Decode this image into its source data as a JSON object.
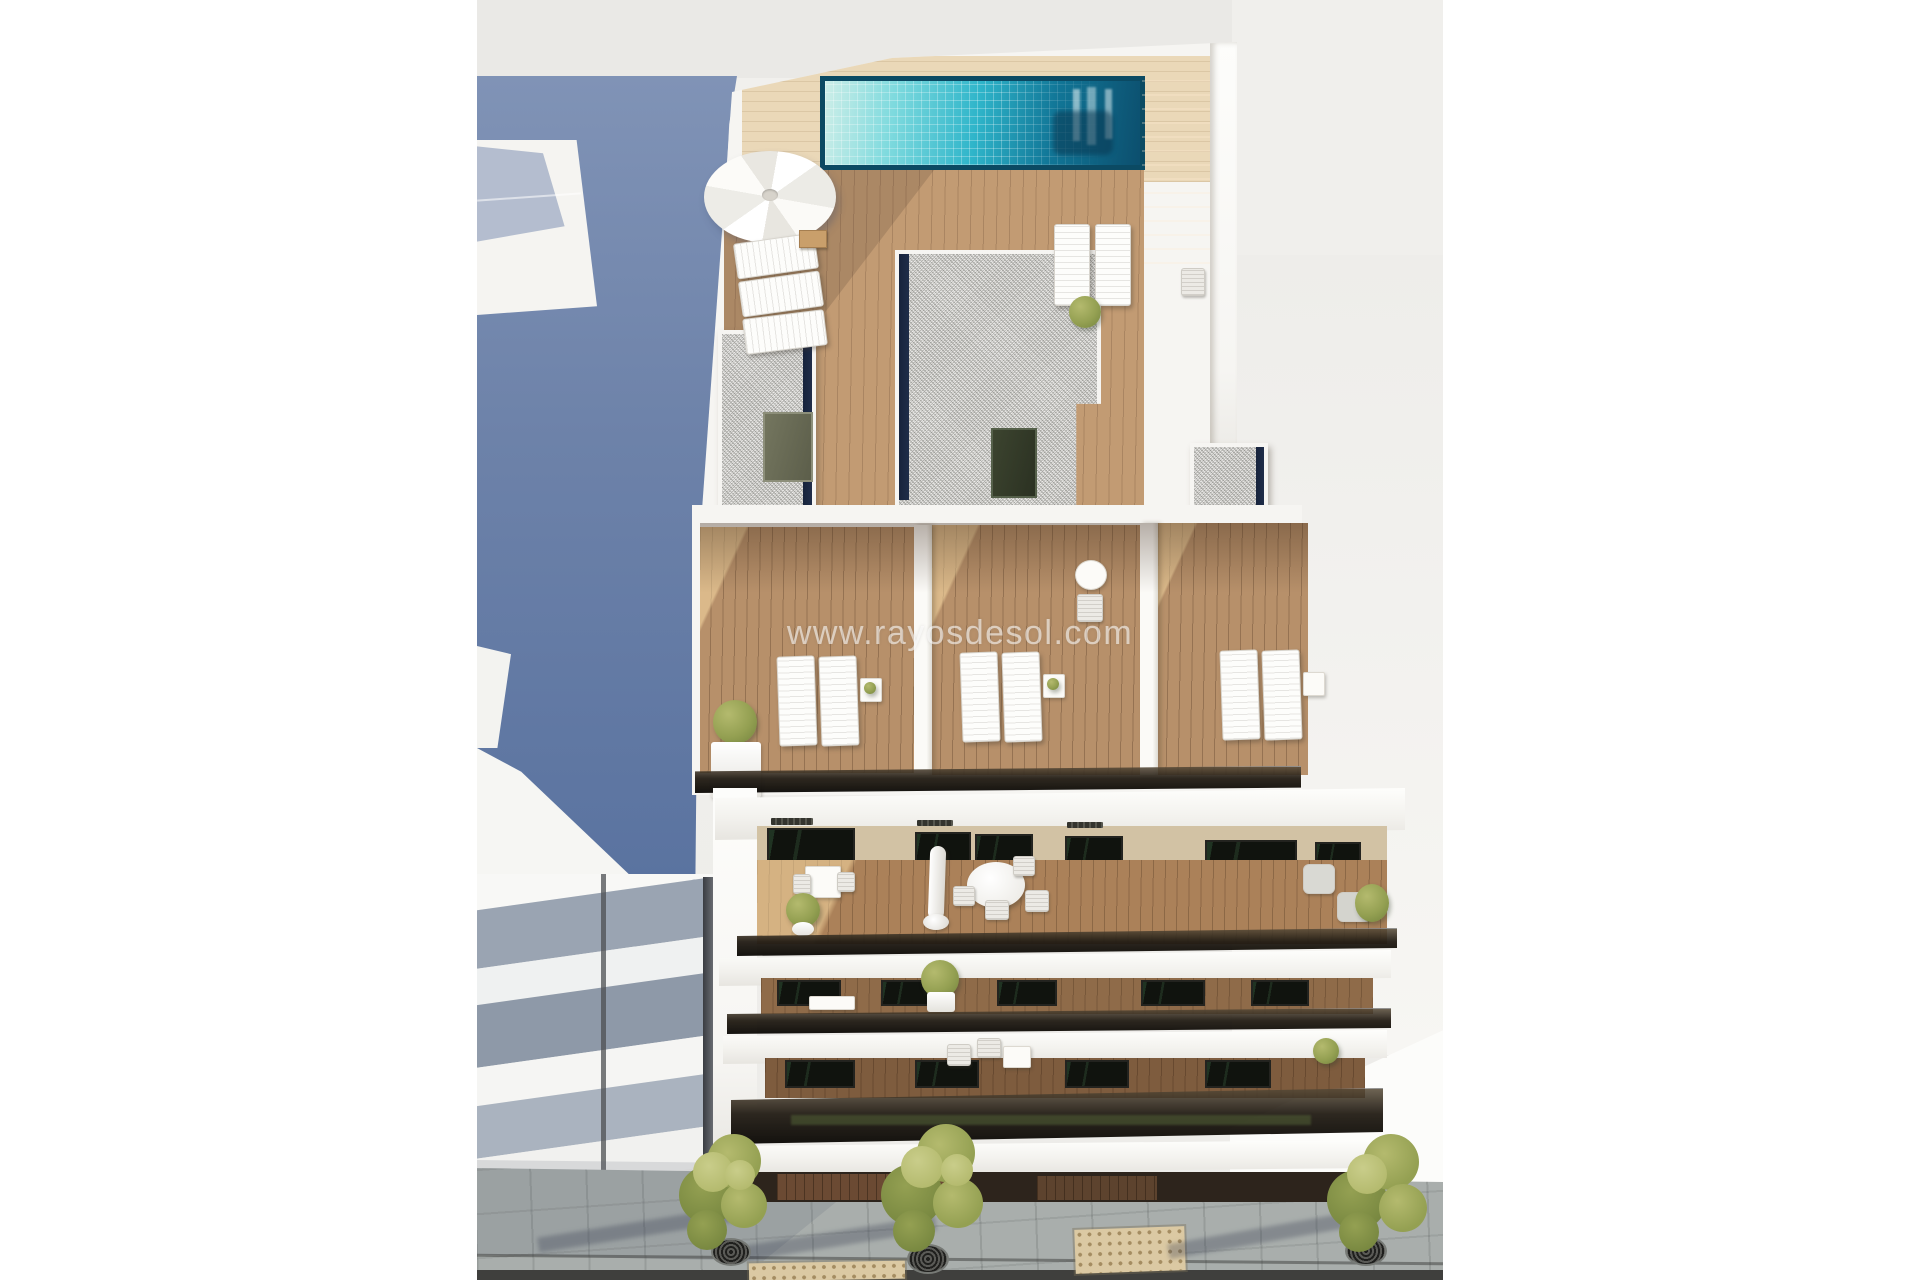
{
  "image": {
    "alt": "Aerial 3D architectural rendering of a modern white apartment building with a rooftop swimming pool, parasols, sun-lounger terraces, furnished balconies, neighbouring buildings and a paved street with trees",
    "watermark": "www.rayosdesol.com"
  },
  "scene": {
    "rooftop": {
      "pool": "rooftop-pool",
      "parasol": "white-parasol",
      "lounger_groups": 2,
      "gravel_roof_volumes": 3,
      "stairs": "dark-wood-stairs"
    },
    "terrace_level": {
      "lounger_pairs": 3,
      "planters": 2,
      "bistro_tables": 1
    },
    "balcony_floors": 3,
    "street": {
      "trees": 3,
      "tree_grates": 3,
      "tactile_paving_patches": 2
    }
  },
  "colors": {
    "margin": "#ffffff",
    "top_band": "#eae9e6",
    "shadow_blue_light": "#8093b6",
    "shadow_blue_dark": "#5a73a0",
    "wall_white": "#f6f5f2",
    "wall_bright": "#fdfdfb",
    "wall_shade": "#e6e4df",
    "pool_border": "#0b4a63",
    "pool_light": "#bdeee6",
    "pool_mid": "#2fb5ca",
    "pool_dark": "#0c4f6e",
    "deck_pale": "#ead8b8",
    "deck_wood": "#c29b73",
    "terrace_wood": "#b7906a",
    "balcony_wood": "#ab8159",
    "stairs_wood": "#5f4631",
    "gravel": "#cbcac6",
    "navy_strip": "#1f2d49",
    "door_glass": "#10130e",
    "foliage_light": "#b4ba6e",
    "foliage_mid": "#94a052",
    "foliage_dark": "#76863f",
    "pavement": "#a9aeac",
    "tactile": "#dbc9a3",
    "road": "#3f3f3d",
    "stripe_white": "#f8f8f6",
    "stripe_grey": "#9aa4b2",
    "stripe_grey2": "#8e99a8",
    "ground_floor_dark": "#2d241c",
    "ground_floor_wood": "#6b4a33",
    "watermark_color": "rgba(255,255,255,0.58)"
  }
}
